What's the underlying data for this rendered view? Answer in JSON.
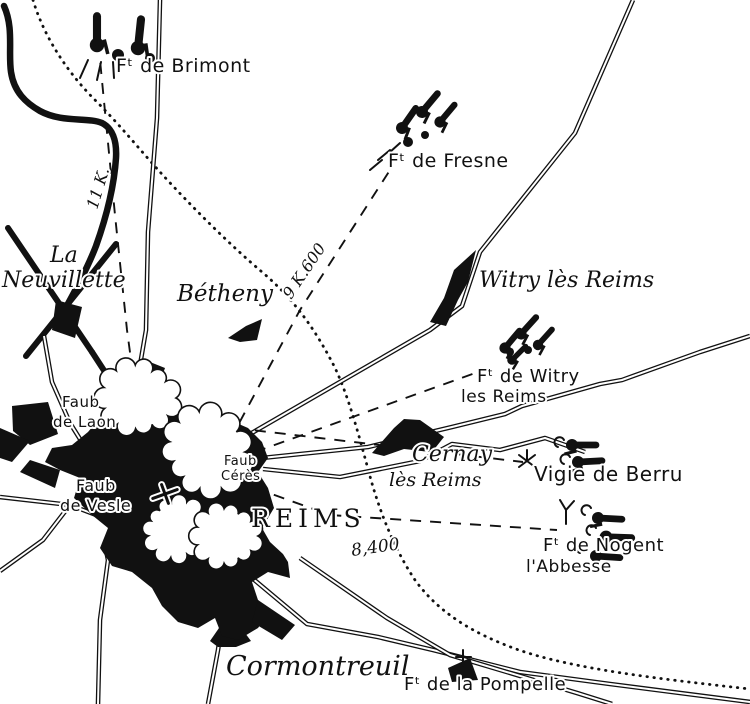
{
  "city": {
    "name": "REIMS"
  },
  "places": {
    "la_neuvillette": {
      "line1": "La",
      "line2": "Neuvillette"
    },
    "betheny": {
      "label": "Bétheny"
    },
    "witry_les_reims": {
      "label": "Witry lès Reims"
    },
    "cernay": {
      "line1": "Cernay",
      "line2": "lès Reims"
    },
    "cormontreuil": {
      "label": "Cormontreuil"
    }
  },
  "faubourgs": {
    "laon": {
      "line1": "Faub",
      "line2": "de Laon"
    },
    "ceres": {
      "line1": "Faub",
      "line2": "Cérès"
    },
    "vesle": {
      "line1": "Faub",
      "line2": "de Vesle"
    }
  },
  "forts": {
    "brimont": {
      "label": "Fᵗ de Brimont"
    },
    "fresne": {
      "label": "Fᵗ de Fresne"
    },
    "witry": {
      "line1": "Fᵗ de Witry",
      "line2": "les Reims"
    },
    "berru": {
      "label": "Vigie de Berru"
    },
    "nogent": {
      "line1": "Fᵗ de Nogent",
      "line2": "l'Abbesse"
    },
    "pompelle": {
      "label": "Fᵗ de la Pompelle"
    }
  },
  "distances": {
    "brimont": "11 K.",
    "fresne": "9 K.600",
    "nogent": "8,400"
  },
  "colors": {
    "ink": "#111111",
    "paper": "#ffffff"
  }
}
